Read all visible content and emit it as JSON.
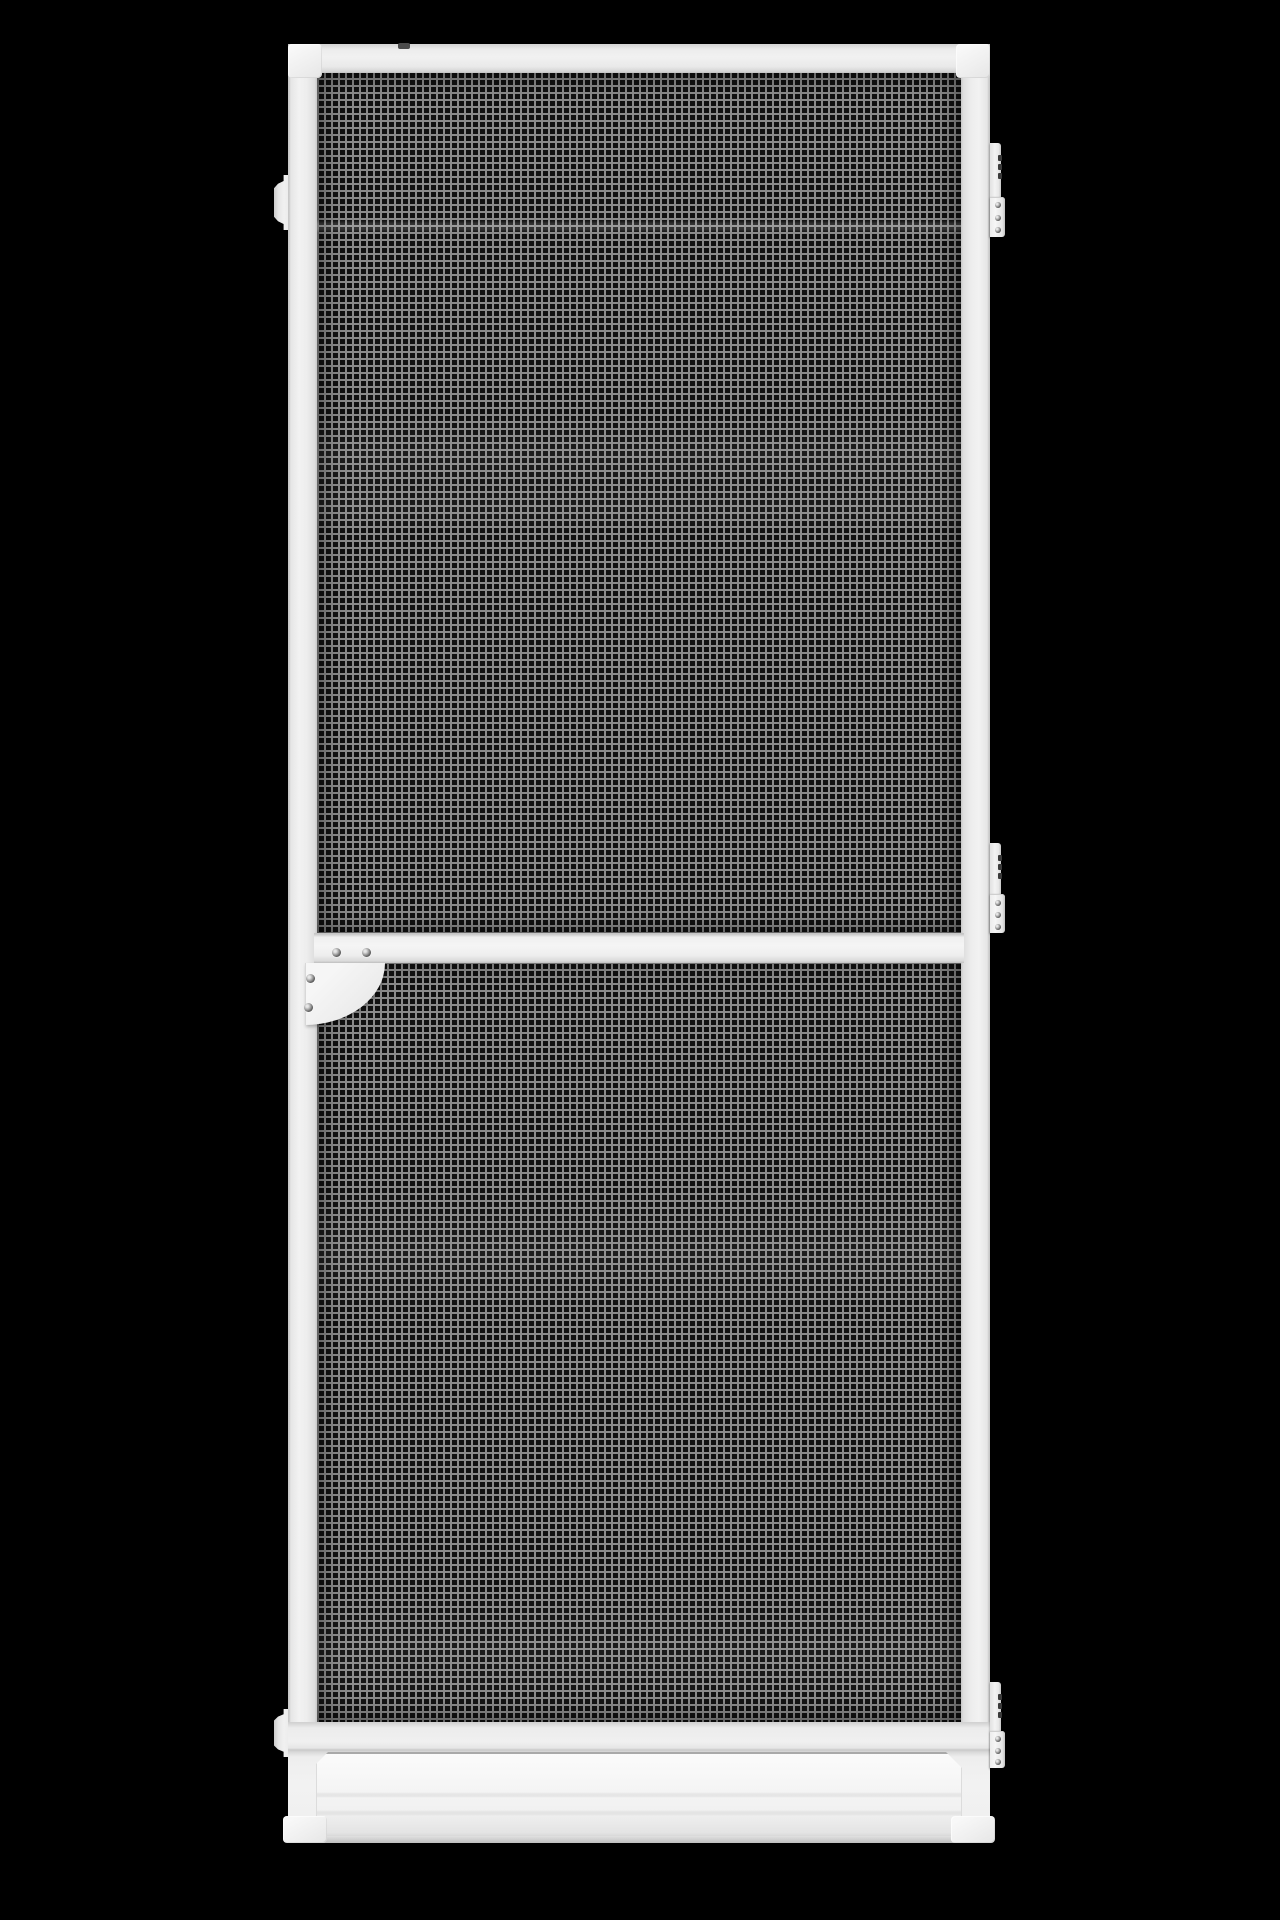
{
  "scene": {
    "description": "Product photo of a white aluminium insect screen door (fly screen door) with black fibreglass mesh, hinged on the right, on a plain black studio background",
    "background_color": "#000000"
  },
  "colors": {
    "background": "#000000",
    "frame": "#efefef",
    "frame_light": "#f6f6f6",
    "frame_shadow": "#c9c9c9",
    "seam": "#d8d8d8",
    "mesh_base": "#111111",
    "mesh_wire": "#8a8a8a",
    "hinge_notch": "#3a3a3a",
    "screw_dark": "#555555"
  },
  "mesh": {
    "pitch_px": 7,
    "wire_px": 2
  },
  "parts": {
    "door": {
      "x": 288,
      "y": 44,
      "w": 702,
      "h": 1799
    },
    "mesh_upper": {
      "x": 317,
      "y": 71,
      "w": 644,
      "h": 864
    },
    "mesh_lower": {
      "x": 317,
      "y": 955,
      "w": 644,
      "h": 768
    },
    "tab_top": {
      "x": 274,
      "y": 175,
      "w": 16,
      "h": 55
    },
    "tab_bottom": {
      "x": 274,
      "y": 1709,
      "w": 16,
      "h": 48
    },
    "top_rail": {
      "x": 288,
      "y": 44,
      "w": 702,
      "h": 29
    },
    "left_stile": {
      "x": 288,
      "y": 44,
      "w": 29,
      "h": 1799
    },
    "right_stile": {
      "x": 961,
      "y": 44,
      "w": 29,
      "h": 1799
    },
    "crossbar": {
      "x": 314,
      "y": 933,
      "w": 650,
      "h": 30
    },
    "bottom_rail": {
      "x": 288,
      "y": 1722,
      "w": 702,
      "h": 121
    },
    "kick_plate": {
      "x": 316,
      "y": 1752,
      "w": 646,
      "h": 84
    },
    "cap_top_left": {
      "x": 288,
      "y": 44,
      "w": 34,
      "h": 34
    },
    "cap_top_right": {
      "x": 956,
      "y": 44,
      "w": 34,
      "h": 34
    },
    "cap_bottom_left": {
      "x": 283,
      "y": 1816,
      "w": 44,
      "h": 27
    },
    "cap_bottom_right": {
      "x": 951,
      "y": 1816,
      "w": 44,
      "h": 27
    },
    "rail_notch": {
      "x": 398,
      "y": 43,
      "w": 12,
      "h": 6
    },
    "bracket": {
      "x": 305,
      "y": 963,
      "w": 80,
      "h": 62
    },
    "bracket_screw_1": {
      "x": 332,
      "y": 948,
      "w": 9,
      "h": 9
    },
    "bracket_screw_2": {
      "x": 362,
      "y": 948,
      "w": 9,
      "h": 9
    },
    "bracket_screw_3": {
      "x": 306,
      "y": 974,
      "w": 9,
      "h": 9
    },
    "bracket_screw_4": {
      "x": 304,
      "y": 1003,
      "w": 9,
      "h": 9
    },
    "hinge_top": {
      "x": 990,
      "y": 143,
      "w": 15,
      "h": 94
    },
    "hinge_middle": {
      "x": 990,
      "y": 843,
      "w": 15,
      "h": 90
    },
    "hinge_bottom": {
      "x": 990,
      "y": 1682,
      "w": 15,
      "h": 86
    }
  }
}
